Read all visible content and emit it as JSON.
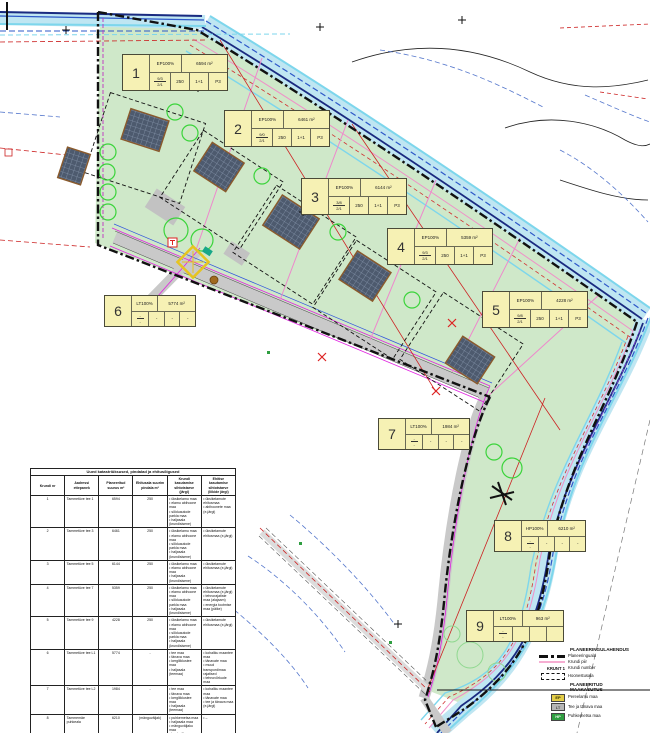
{
  "plots": [
    {
      "num": "1",
      "use": "EP100%",
      "area": "6594 m²",
      "fr_top": "9/3",
      "fr_bot": "2/1",
      "c1": "250",
      "c2": "1+1",
      "c3": "P3"
    },
    {
      "num": "2",
      "use": "EP100%",
      "area": "6461 m²",
      "fr_top": "9/0",
      "fr_bot": "2/1",
      "c1": "250",
      "c2": "1+1",
      "c3": "P3"
    },
    {
      "num": "3",
      "use": "EP100%",
      "area": "6144 m²",
      "fr_top": "3/8",
      "fr_bot": "2/1",
      "c1": "250",
      "c2": "1+1",
      "c3": "P3"
    },
    {
      "num": "4",
      "use": "EP100%",
      "area": "5359 m²",
      "fr_top": "9/3",
      "fr_bot": "2/1",
      "c1": "250",
      "c2": "1+1",
      "c3": "P3"
    },
    {
      "num": "5",
      "use": "EP100%",
      "area": "4228 m²",
      "fr_top": "9/8",
      "fr_bot": "2/1",
      "c1": "250",
      "c2": "1+1",
      "c3": "P3"
    },
    {
      "num": "6",
      "use": "LT100%",
      "area": "5774 m²",
      "fr_top": "-",
      "fr_bot": "-",
      "c1": "-",
      "c2": "-",
      "c3": "-"
    },
    {
      "num": "7",
      "use": "LT100%",
      "area": "1984 m²",
      "fr_top": "-",
      "fr_bot": "-",
      "c1": "-",
      "c2": "-",
      "c3": "-"
    },
    {
      "num": "8",
      "use": "HP100%",
      "area": "6210 m²",
      "fr_top": "-",
      "fr_bot": "-",
      "c1": "-",
      "c2": "-",
      "c3": "-"
    },
    {
      "num": "9",
      "use": "LT100%",
      "area": "963 m²",
      "fr_top": "-",
      "fr_bot": "-",
      "c1": "",
      "c2": "",
      "c3": ""
    }
  ],
  "table": {
    "title": "Uued katastriüksused, pindalad ja ehitusõigused",
    "headers": [
      "Krundi nr",
      "Aadressi ettepanek",
      "Planeeritud suurus m²",
      "Ehitusala suurim pindala m²",
      "Krundi kasutamise sihtotstarve (järgi)",
      "Ehitise kasutamise sihtotstarve (liikide järgi)"
    ],
    "rows": [
      [
        "1",
        "Tammetüve tee 1",
        "6594",
        "250",
        "• üksikelamu maa\n• elamu abihoone maa\n• sõiduautode parkla maa\n• haljasala (krundisisene)",
        "• üksikelamute ehitusmaa\n• abihoonete maa (e-järgi)"
      ],
      [
        "2",
        "Tammetüve tee 3",
        "6461",
        "250",
        "• üksikelamu maa\n• elamu abihoone maa\n• sõiduautode parkla maa\n• haljasala (krundisisene)",
        "• üksikelamute ehitusmaa (e-järgi)"
      ],
      [
        "3",
        "Tammetüve tee 5",
        "6144",
        "250",
        "• üksikelamu maa\n• elamu abihoone maa\n• haljasala (krundisisene)",
        "• üksikelamute ehitusmaa (e-järgi)"
      ],
      [
        "4",
        "Tammetüve tee 7",
        "5359",
        "250",
        "• üksikelamu maa\n• elamu abihoone maa\n• sõiduautode parkla maa\n• haljasala (krundisisene)",
        "• üksikelamute ehitusmaa (e-järgi)\n• tehnorajatiste maa (alajaam)\n• energia tootmise maa (päike)"
      ],
      [
        "5",
        "Tammetüve tee 9",
        "4228",
        "250",
        "• üksikelamu maa\n• elamu abihoone maa\n• sõiduautode parkla maa\n• haljasala (krundisisene)",
        "• üksikelamute ehitusmaa (e-järgi)"
      ],
      [
        "6",
        "Tammetüve tee L1",
        "5774",
        "-",
        "• tee maa\n• tänava maa\n• kergliiklustee maa\n• haljasala (teemaa)",
        "• kohaliku maantee maa\n• tänavate maa\n• muud transpordimaa rajatised\n• tehnovõrkude maa"
      ],
      [
        "7",
        "Tammetüve tee L2",
        "1984",
        "-",
        "• tee maa\n• tänava maa\n• kergliiklustee maa\n• haljasala (teemaa)",
        "• kohaliku maantee maa\n• tänavate maa\n• tee ja tänava maa (e-järgi)"
      ],
      [
        "8",
        "Tammemäe puhkeala",
        "6210",
        "(mänguväljak)",
        "• puhkemetsa maa\n• haljasala maa\n• mänguväljaku maa\n• looduslik maa",
        "• –"
      ],
      [
        "9",
        "Nugise tee L1",
        "963",
        "-",
        "• tee maa\n• tänava maa\n• kergliiklustee maa\n• haljasala (teemaa)",
        "• tee ja tänava maa (e-järgi)"
      ]
    ]
  },
  "legend": {
    "h1": "PLANEERINGULAHENDUS",
    "items1": [
      {
        "label": "Planeeringuala"
      },
      {
        "label": "Krundi piir"
      },
      {
        "sym_text": "KRUNT 1",
        "label": "Krundi number"
      },
      {
        "label": "Hoonestusala"
      }
    ],
    "h2": "PLANEERITUD\nMAAKASUTUS",
    "items2": [
      {
        "code": "EP",
        "color": "#e3cd47",
        "text_color": "#332f00",
        "label": "Pereelamu maa"
      },
      {
        "code": "LT",
        "color": "#b6b6b6",
        "text_color": "#4a4a4a",
        "label": "Tee ja tänava maa"
      },
      {
        "code": "HP",
        "color": "#2f9e41",
        "text_color": "#eef8ee",
        "label": "Puhkemetsa maa"
      }
    ]
  },
  "colors": {
    "site_green": "#cfe8c9",
    "water_cyan": "#7dd6ec",
    "plot_pink": "#f6aed2",
    "label_yellow": "#f6f1b4",
    "boundary_black": "#111111",
    "cadastral_red": "#cc2222"
  }
}
